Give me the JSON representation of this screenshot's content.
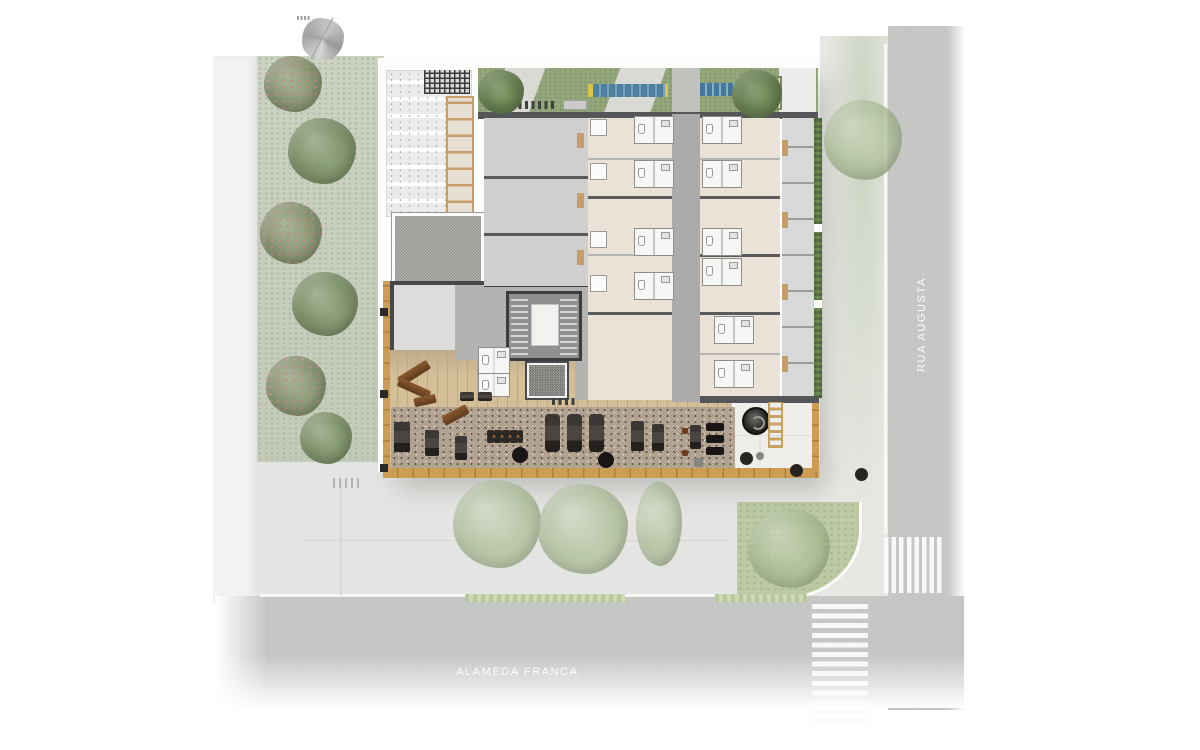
{
  "labels": {
    "street_vertical": "RUA AUGUSTA",
    "street_horizontal": "ALAMEDA FRANCA"
  },
  "icons": {
    "compass": "north-arrow-icon"
  },
  "colors": {
    "street": "#c6c8c5",
    "sidewalk": "#e4e5e2",
    "building_wall": "#55565a",
    "unit_floor": "#eae2d6",
    "corridor": "#ababab",
    "bathroom": "#f6f6f4",
    "wood_deck": "#d5bf99",
    "wood_frame": "#c0893f",
    "pebble_floor": "#b2a495",
    "gravel": "#a4a4a0",
    "grass": "#94a67b",
    "hedge": "#5f7a48",
    "tree": "#8ea27a",
    "solar_panel_blue": "#4b7d9e",
    "solar_panel_yellow": "#d9c44c",
    "elevator_cab": "#b4aa97",
    "elevator_door": "#a89c6e",
    "crosswalk_stripe": "#ffffff",
    "street_label_text": "#fcfcfc",
    "equipment_dark": "#2e2a28",
    "equipment_brown": "#7a4a28"
  }
}
